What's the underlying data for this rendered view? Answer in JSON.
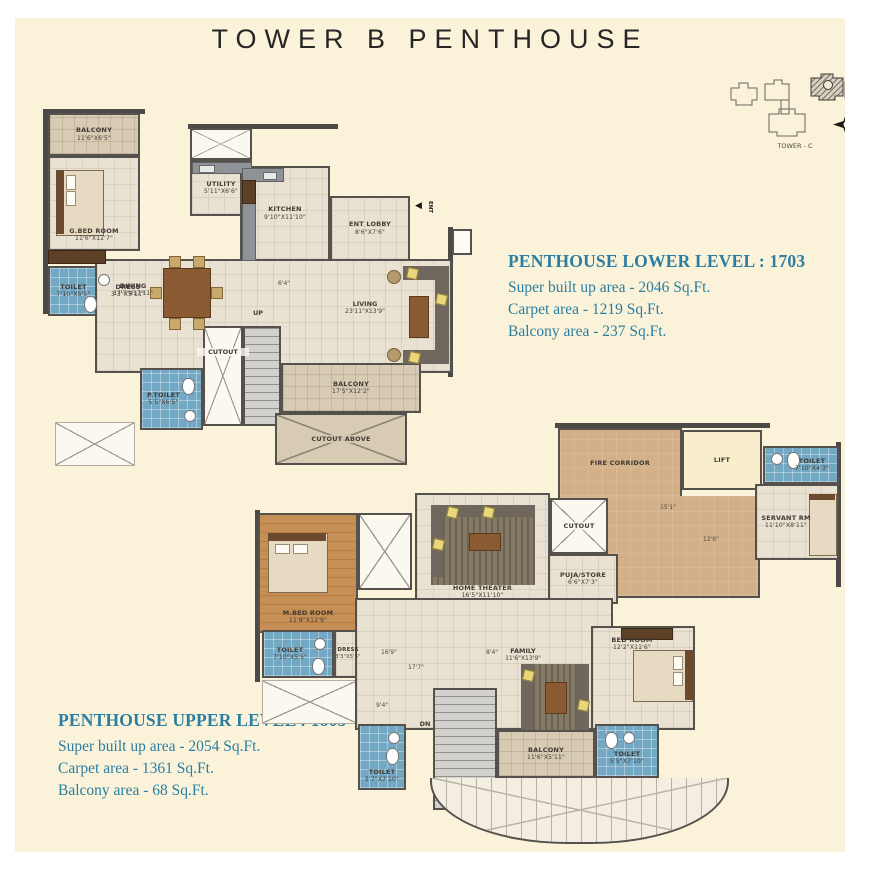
{
  "title": "TOWER B PENTHOUSE",
  "key_plan": {
    "tower_label": "TOWER - C"
  },
  "lower_info": {
    "title": "PENTHOUSE LOWER LEVEL : 1703",
    "lines": [
      "Super built up area - 2046 Sq.Ft.",
      "Carpet area - 1219 Sq.Ft.",
      "Balcony area - 237 Sq.Ft."
    ]
  },
  "upper_info": {
    "title": "PENTHOUSE UPPER LEVEL : 1803",
    "lines": [
      "Super built up area - 2054 Sq.Ft.",
      "Carpet area - 1361 Sq.Ft.",
      "Balcony area - 68 Sq.Ft."
    ]
  },
  "lower_plan": {
    "balcony_top": {
      "name": "BALCONY",
      "size": "11'6\"X6'5\""
    },
    "g_bed_room": {
      "name": "G.BED ROOM",
      "size": "11'6\"X12'7\""
    },
    "toilet": {
      "name": "TOILET",
      "size": "7'10\"X5'5\""
    },
    "dress": {
      "name": "DRESS",
      "size": "3'3\"X5'11\""
    },
    "utility": {
      "name": "UTILITY",
      "size": "5'11\"X6'6\""
    },
    "kitchen": {
      "name": "KITCHEN",
      "size": "9'10\"X11'10\""
    },
    "ent_lobby": {
      "name": "ENT LOBBY",
      "size": "8'6\"X7'6\""
    },
    "ent": "ENT",
    "dining": {
      "name": "DINING",
      "size": "17'7\"X17'11\""
    },
    "living": {
      "name": "LIVING",
      "size": "23'11\"X13'9\""
    },
    "dim_mid": "6'4\"",
    "up": "UP",
    "cutout": "CUTOUT",
    "p_toilet": {
      "name": "P.TOILET",
      "size": "5'5\"X6'5\""
    },
    "balcony_bottom": {
      "name": "BALCONY",
      "size": "17'5\"X12'2\""
    },
    "cutout_above": "CUTOUT ABOVE"
  },
  "upper_plan": {
    "fire_corridor": "FIRE CORRIDOR",
    "lift": "LIFT",
    "toilet_top": {
      "name": "TOILET",
      "size": "7'10\"X4'3\""
    },
    "servant_rm": {
      "name": "SERVANT RM",
      "size": "11'10\"X8'11\""
    },
    "cutout": "CUTOUT",
    "puja_store": {
      "name": "PUJA/STORE",
      "size": "6'6\"X7'3\""
    },
    "home_theater": {
      "name": "HOME THEATER",
      "size": "16'5\"X11'10\""
    },
    "m_bed_room": {
      "name": "M.BED ROOM",
      "size": "11'8\"X12'9\""
    },
    "toilet_m": {
      "name": "TOILET",
      "size": "7'10\"X5'5\""
    },
    "dress": {
      "name": "DRESS",
      "size": "3'3\"X5'5\""
    },
    "family": {
      "name": "FAMILY",
      "size": "11'6\"X13'9\""
    },
    "bed_room": {
      "name": "BED ROOM",
      "size": "12'2\"X11'6\""
    },
    "balcony": {
      "name": "BALCONY",
      "size": "11'6\"X5'11\""
    },
    "toilet_r": {
      "name": "TOILET",
      "size": "5'5\"X7'10\""
    },
    "toilet_l": {
      "name": "TOILET",
      "size": "5'7\"X7'10\""
    },
    "dn": "DN",
    "dim_15_1": "15'1\"",
    "dim_12_6": "12'6\"",
    "dim_16_9": "16'9\"",
    "dim_17_7": "17'7\"",
    "dim_8_4": "8'4\"",
    "dim_9_4": "9'4\""
  },
  "colors": {
    "background": "#faf3da",
    "info_text": "#2b7ea1",
    "title_text": "#262626",
    "wall": "#4c4a47",
    "bath_blue": "#73a8c4",
    "wood_floor": "#c68f55",
    "corridor_tan": "#d4b089"
  }
}
